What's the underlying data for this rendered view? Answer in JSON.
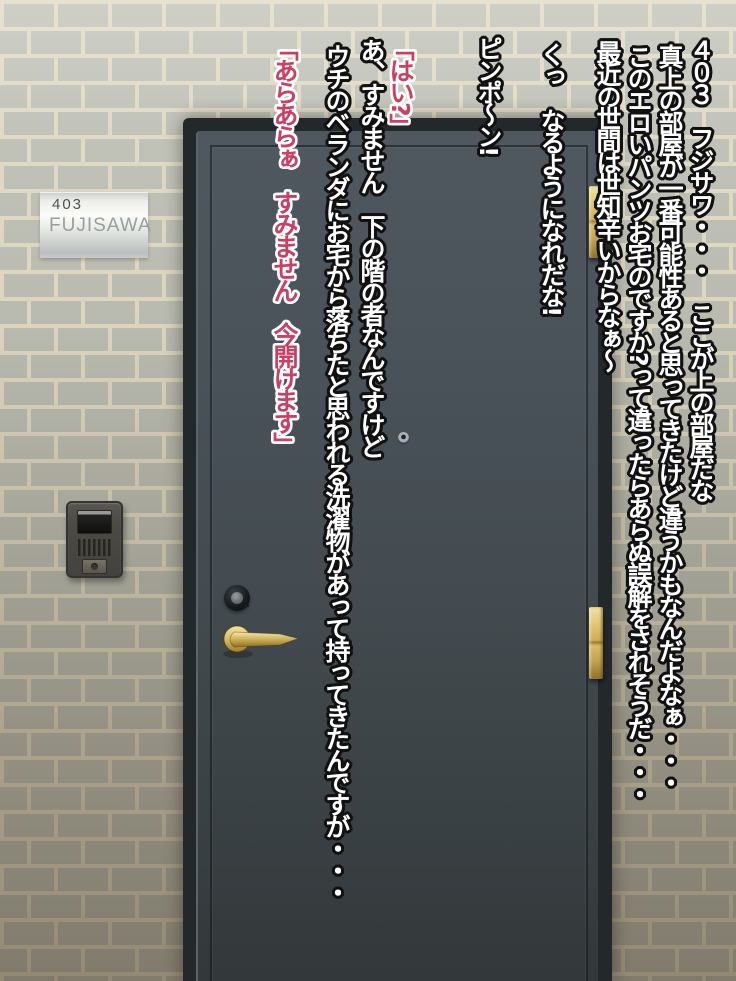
{
  "scene": {
    "nameplate": {
      "room_number": "403",
      "name": "FUJISAWA"
    },
    "dialogue": {
      "lines": [
        {
          "text": "４０３　フジサワ・・・　ここが上の部屋だな",
          "type": "narration"
        },
        {
          "text": "真上の部屋が一番可能性あると思ってきたけど違うかもなんだよなぁ・・・",
          "type": "narration"
        },
        {
          "text": "このエロいパンツお宅のですか?って違ったらあらぬ誤解をされそうだ・・・",
          "type": "narration"
        },
        {
          "text": "最近の世間は世知辛いからなぁ～",
          "type": "narration"
        },
        {
          "text": "くっ　なるようになれだな!",
          "type": "narration"
        },
        {
          "text": "ピンポ～ン!",
          "type": "sfx"
        },
        {
          "text": "「はい?」",
          "type": "speech"
        },
        {
          "text": "あ、すみません　下の階の者なんですけど",
          "type": "narration"
        },
        {
          "text": "ウチのベランダにお宅から落ちたと思われる洗濯物があって持ってきたんですが・・・",
          "type": "narration"
        },
        {
          "text": "「あらあらぁ　すみません　今開けます」",
          "type": "speech"
        }
      ]
    },
    "colors": {
      "narration_text": "#ffffff",
      "narration_outline": "#111111",
      "speech_text": "#cc3f63",
      "speech_outline": "#ffffff",
      "door": "#49525a",
      "door_frame": "#23282b",
      "hinge_gold": "#d8bc69",
      "wall_tile": "#b9bbb1",
      "grout": "#ddd5bd"
    }
  }
}
